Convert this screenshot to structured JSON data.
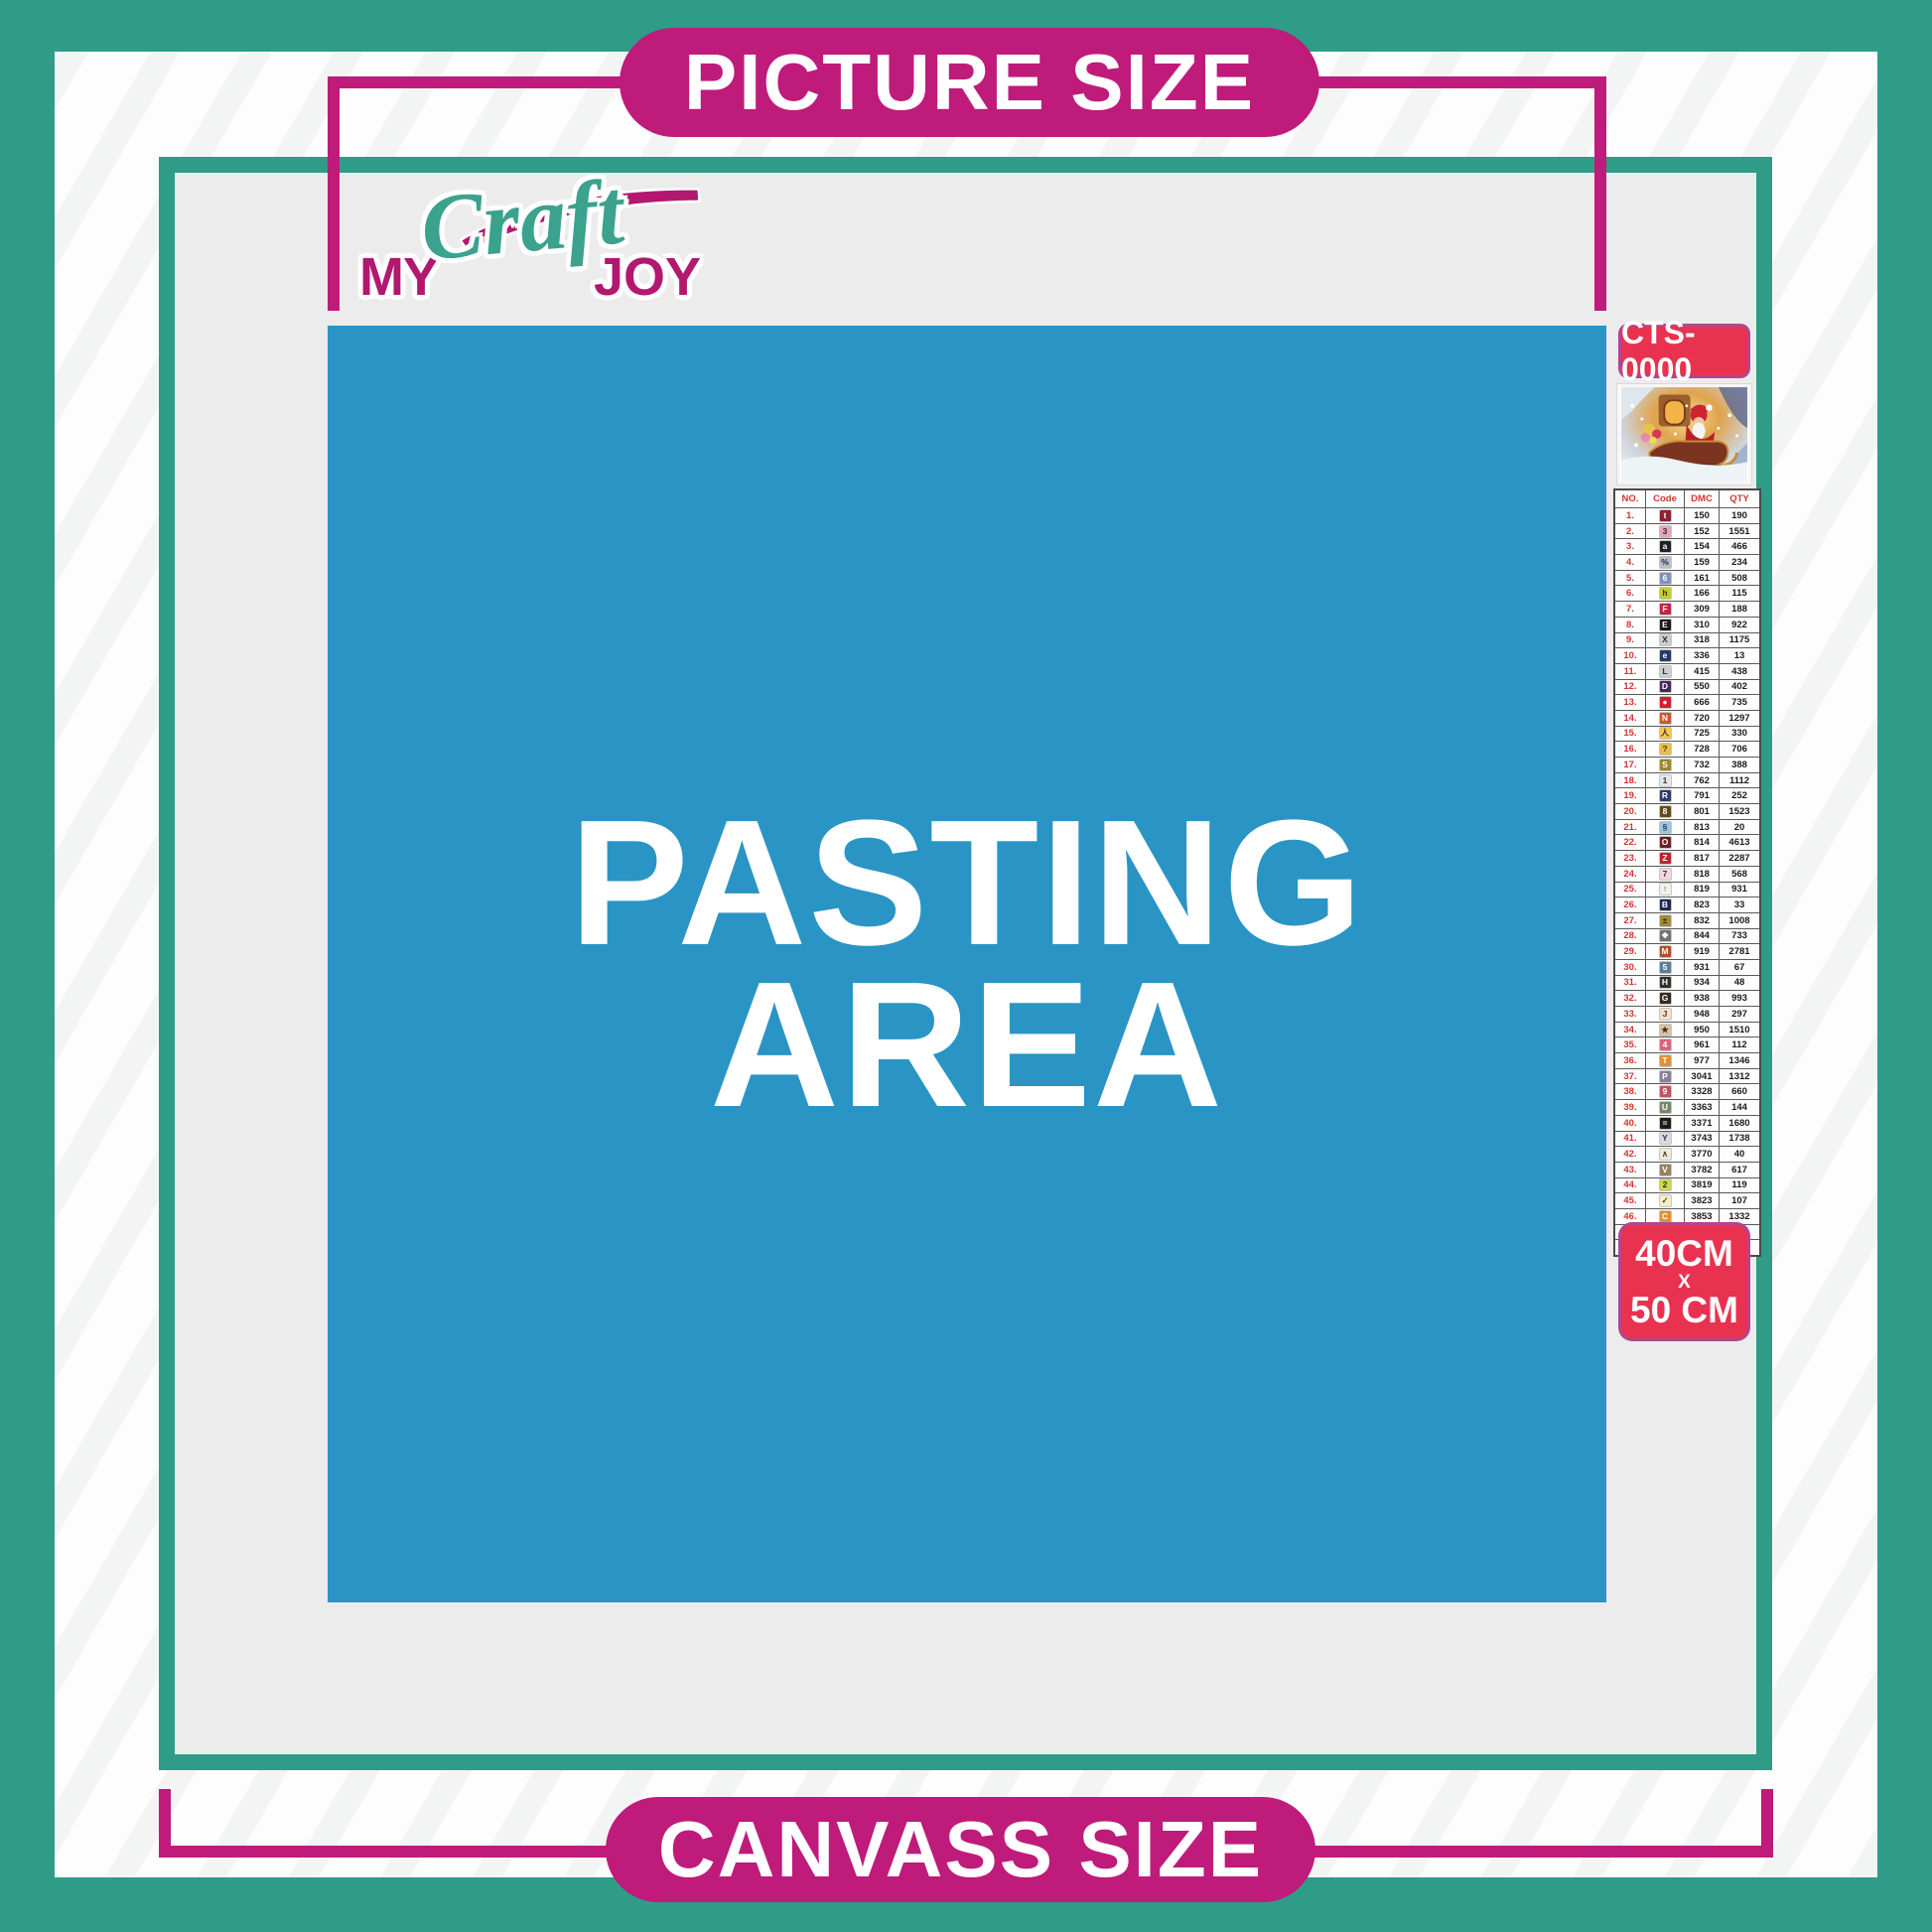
{
  "labels": {
    "picture_size": "PICTURE SIZE",
    "canvass_size": "CANVASS SIZE"
  },
  "logo": {
    "my": "MY",
    "craft": "Craft",
    "joy": "JOY"
  },
  "pasting_area": {
    "line1": "PASTING",
    "line2": "AREA"
  },
  "sidebar": {
    "product_code": "CTS-0000",
    "thumbnail_icon": "santa-sleigh-christmas-scene",
    "size_label": {
      "line1": "40CM",
      "x": "X",
      "line2": "50 CM"
    },
    "table": {
      "headers": [
        "NO.",
        "Code",
        "DMC",
        "QTY"
      ],
      "rows": [
        {
          "no": "1.",
          "symbol": "t",
          "chip_bg": "#8c2030",
          "chip_fg": "#ffffff",
          "dmc": "150",
          "qty": "190"
        },
        {
          "no": "2.",
          "symbol": "3",
          "chip_bg": "#e3a8b4",
          "chip_fg": "#3a2a30",
          "dmc": "152",
          "qty": "1551"
        },
        {
          "no": "3.",
          "symbol": "a",
          "chip_bg": "#241f26",
          "chip_fg": "#ffffff",
          "dmc": "154",
          "qty": "466"
        },
        {
          "no": "4.",
          "symbol": "%",
          "chip_bg": "#b9bcc9",
          "chip_fg": "#2b2b33",
          "dmc": "159",
          "qty": "234"
        },
        {
          "no": "5.",
          "symbol": "6",
          "chip_bg": "#7f94bb",
          "chip_fg": "#ffffff",
          "dmc": "161",
          "qty": "508"
        },
        {
          "no": "6.",
          "symbol": "h",
          "chip_bg": "#c6cc30",
          "chip_fg": "#33350e",
          "dmc": "166",
          "qty": "115"
        },
        {
          "no": "7.",
          "symbol": "F",
          "chip_bg": "#c22745",
          "chip_fg": "#ffffff",
          "dmc": "309",
          "qty": "188"
        },
        {
          "no": "8.",
          "symbol": "E",
          "chip_bg": "#1a1a1a",
          "chip_fg": "#ffffff",
          "dmc": "310",
          "qty": "922"
        },
        {
          "no": "9.",
          "symbol": "X",
          "chip_bg": "#c9ccd1",
          "chip_fg": "#2e2e34",
          "dmc": "318",
          "qty": "1175"
        },
        {
          "no": "10.",
          "symbol": "e",
          "chip_bg": "#253a66",
          "chip_fg": "#ffffff",
          "dmc": "336",
          "qty": "13"
        },
        {
          "no": "11.",
          "symbol": "L",
          "chip_bg": "#ccced4",
          "chip_fg": "#2e2e34",
          "dmc": "415",
          "qty": "438"
        },
        {
          "no": "12.",
          "symbol": "D",
          "chip_bg": "#46275c",
          "chip_fg": "#ffffff",
          "dmc": "550",
          "qty": "402"
        },
        {
          "no": "13.",
          "symbol": "●",
          "chip_bg": "#d01f2e",
          "chip_fg": "#ffffff",
          "dmc": "666",
          "qty": "735"
        },
        {
          "no": "14.",
          "symbol": "N",
          "chip_bg": "#d2542a",
          "chip_fg": "#ffffff",
          "dmc": "720",
          "qty": "1297"
        },
        {
          "no": "15.",
          "symbol": "人",
          "chip_bg": "#f2c94e",
          "chip_fg": "#4a3a10",
          "dmc": "725",
          "qty": "330"
        },
        {
          "no": "16.",
          "symbol": "?",
          "chip_bg": "#e9bd4a",
          "chip_fg": "#4a3a10",
          "dmc": "728",
          "qty": "706"
        },
        {
          "no": "17.",
          "symbol": "S",
          "chip_bg": "#9a8730",
          "chip_fg": "#ffffff",
          "dmc": "732",
          "qty": "388"
        },
        {
          "no": "18.",
          "symbol": "1",
          "chip_bg": "#e6e7e9",
          "chip_fg": "#333338",
          "dmc": "762",
          "qty": "1112"
        },
        {
          "no": "19.",
          "symbol": "R",
          "chip_bg": "#2c3c6e",
          "chip_fg": "#ffffff",
          "dmc": "791",
          "qty": "252"
        },
        {
          "no": "20.",
          "symbol": "8",
          "chip_bg": "#64491f",
          "chip_fg": "#ffffff",
          "dmc": "801",
          "qty": "1523"
        },
        {
          "no": "21.",
          "symbol": "§",
          "chip_bg": "#9cc3e0",
          "chip_fg": "#27435c",
          "dmc": "813",
          "qty": "20"
        },
        {
          "no": "22.",
          "symbol": "O",
          "chip_bg": "#6e1f28",
          "chip_fg": "#ffffff",
          "dmc": "814",
          "qty": "4613"
        },
        {
          "no": "23.",
          "symbol": "Z",
          "chip_bg": "#bf2330",
          "chip_fg": "#ffffff",
          "dmc": "817",
          "qty": "2287"
        },
        {
          "no": "24.",
          "symbol": "7",
          "chip_bg": "#f2d7dc",
          "chip_fg": "#4a3238",
          "dmc": "818",
          "qty": "568"
        },
        {
          "no": "25.",
          "symbol": "↑",
          "chip_bg": "#f4efe9",
          "chip_fg": "#4a4440",
          "dmc": "819",
          "qty": "931"
        },
        {
          "no": "26.",
          "symbol": "B",
          "chip_bg": "#1c2950",
          "chip_fg": "#ffffff",
          "dmc": "823",
          "qty": "33"
        },
        {
          "no": "27.",
          "symbol": "±",
          "chip_bg": "#a08b3a",
          "chip_fg": "#2e2710",
          "dmc": "832",
          "qty": "1008"
        },
        {
          "no": "28.",
          "symbol": "❖",
          "chip_bg": "#6f7277",
          "chip_fg": "#ffffff",
          "dmc": "844",
          "qty": "733"
        },
        {
          "no": "29.",
          "symbol": "M",
          "chip_bg": "#b0502a",
          "chip_fg": "#ffffff",
          "dmc": "919",
          "qty": "2781"
        },
        {
          "no": "30.",
          "symbol": "5",
          "chip_bg": "#5a7e99",
          "chip_fg": "#ffffff",
          "dmc": "931",
          "qty": "67"
        },
        {
          "no": "31.",
          "symbol": "H",
          "chip_bg": "#2c3328",
          "chip_fg": "#ffffff",
          "dmc": "934",
          "qty": "48"
        },
        {
          "no": "32.",
          "symbol": "G",
          "chip_bg": "#362820",
          "chip_fg": "#ffffff",
          "dmc": "938",
          "qty": "993"
        },
        {
          "no": "33.",
          "symbol": "J",
          "chip_bg": "#f5dfca",
          "chip_fg": "#4a3a2a",
          "dmc": "948",
          "qty": "297"
        },
        {
          "no": "34.",
          "symbol": "★",
          "chip_bg": "#d9c2a4",
          "chip_fg": "#3a2e1e",
          "dmc": "950",
          "qty": "1510"
        },
        {
          "no": "35.",
          "symbol": "4",
          "chip_bg": "#d9667e",
          "chip_fg": "#ffffff",
          "dmc": "961",
          "qty": "112"
        },
        {
          "no": "36.",
          "symbol": "T",
          "chip_bg": "#e08f3a",
          "chip_fg": "#ffffff",
          "dmc": "977",
          "qty": "1346"
        },
        {
          "no": "37.",
          "symbol": "P",
          "chip_bg": "#8c7f99",
          "chip_fg": "#ffffff",
          "dmc": "3041",
          "qty": "1312"
        },
        {
          "no": "38.",
          "symbol": "9",
          "chip_bg": "#c25663",
          "chip_fg": "#ffffff",
          "dmc": "3328",
          "qty": "660"
        },
        {
          "no": "39.",
          "symbol": "U",
          "chip_bg": "#78876a",
          "chip_fg": "#ffffff",
          "dmc": "3363",
          "qty": "144"
        },
        {
          "no": "40.",
          "symbol": "=",
          "chip_bg": "#211b18",
          "chip_fg": "#ffffff",
          "dmc": "3371",
          "qty": "1680"
        },
        {
          "no": "41.",
          "symbol": "Y",
          "chip_bg": "#d9d7e4",
          "chip_fg": "#38343e",
          "dmc": "3743",
          "qty": "1738"
        },
        {
          "no": "42.",
          "symbol": "∧",
          "chip_bg": "#f2ead9",
          "chip_fg": "#4a4436",
          "dmc": "3770",
          "qty": "40"
        },
        {
          "no": "43.",
          "symbol": "V",
          "chip_bg": "#98815f",
          "chip_fg": "#ffffff",
          "dmc": "3782",
          "qty": "617"
        },
        {
          "no": "44.",
          "symbol": "2",
          "chip_bg": "#ccd64e",
          "chip_fg": "#333910",
          "dmc": "3819",
          "qty": "119"
        },
        {
          "no": "45.",
          "symbol": "✓",
          "chip_bg": "#f4edc6",
          "chip_fg": "#4a4426",
          "dmc": "3823",
          "qty": "107"
        },
        {
          "no": "46.",
          "symbol": "C",
          "chip_bg": "#e28f35",
          "chip_fg": "#ffffff",
          "dmc": "3853",
          "qty": "1332"
        },
        {
          "no": "47.",
          "symbol": "K",
          "chip_bg": "#7c4b42",
          "chip_fg": "#ffffff",
          "dmc": "3858",
          "qty": "2311"
        },
        {
          "no": "48.",
          "symbol": "A",
          "chip_bg": "#8f8176",
          "chip_fg": "#ffffff",
          "dmc": "3863",
          "qty": "1820"
        }
      ]
    }
  },
  "colors": {
    "teal": "#2f9c88",
    "magenta": "#be1b7b",
    "badge_red": "#e93250",
    "pasting_blue": "#2a95c5",
    "content_gray": "#ececec"
  }
}
